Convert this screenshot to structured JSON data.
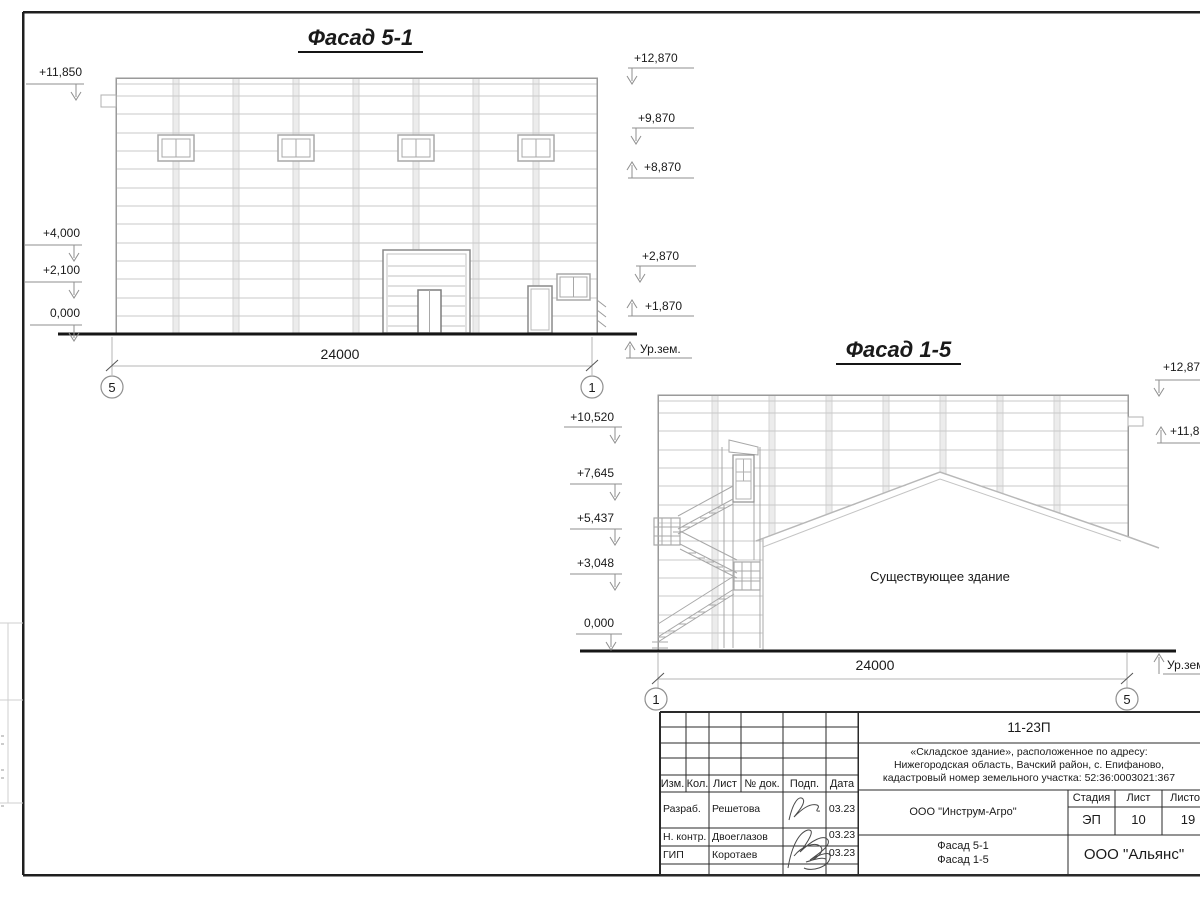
{
  "colors": {
    "ink": "#1a1a1a",
    "grid_light": "#c9c9c9",
    "line_mid": "#9a9a9a",
    "band": "#ececec"
  },
  "f51": {
    "title": "Фасад 5-1",
    "marks_left": [
      "+11,850",
      "+4,000",
      "+2,100",
      "0,000"
    ],
    "marks_right": [
      "+12,870",
      "+9,870",
      "+8,870",
      "+2,870",
      "+1,870"
    ],
    "ground_label": "Ур.зем.",
    "dimension": "24000",
    "axis_left": "5",
    "axis_right": "1"
  },
  "f15": {
    "title": "Фасад 1-5",
    "marks_left": [
      "+10,520",
      "+7,645",
      "+5,437",
      "+3,048",
      "0,000"
    ],
    "marks_right": [
      "+12,870",
      "+11,850"
    ],
    "ground_label": "Ур.зем.",
    "dimension": "24000",
    "axis_left": "1",
    "axis_right": "5",
    "existing_label": "Существующее здание"
  },
  "tb": {
    "doc_number": "11-23П",
    "address1": "«Складское здание», расположенное по адресу:",
    "address2": "Нижегородская область, Вачский район, с. Епифаново,",
    "address3": "кадастровый номер земельного участка: 52:36:0003021:367",
    "col_izm": "Изм.",
    "col_kol": "Кол.",
    "col_list": "Лист",
    "col_doc": "№ док.",
    "col_podp": "Подп.",
    "col_data": "Дата",
    "row1_role": "Разраб.",
    "row1_name": "Решетова",
    "row1_date": "03.23",
    "row2_role": "Н. контр.",
    "row2_name": "Двоеглазов",
    "row2_date": "03.23",
    "row3_role": "ГИП",
    "row3_name": "Коротаев",
    "row3_date": "03.23",
    "client": "ООО \"Инструм-Агро\"",
    "stage_label": "Стадия",
    "list_label": "Лист",
    "listov_label": "Листов",
    "stage": "ЭП",
    "list": "10",
    "listov": "19",
    "title1": "Фасад 5-1",
    "title2": "Фасад 1-5",
    "company": "ООО \"Альянс\""
  }
}
